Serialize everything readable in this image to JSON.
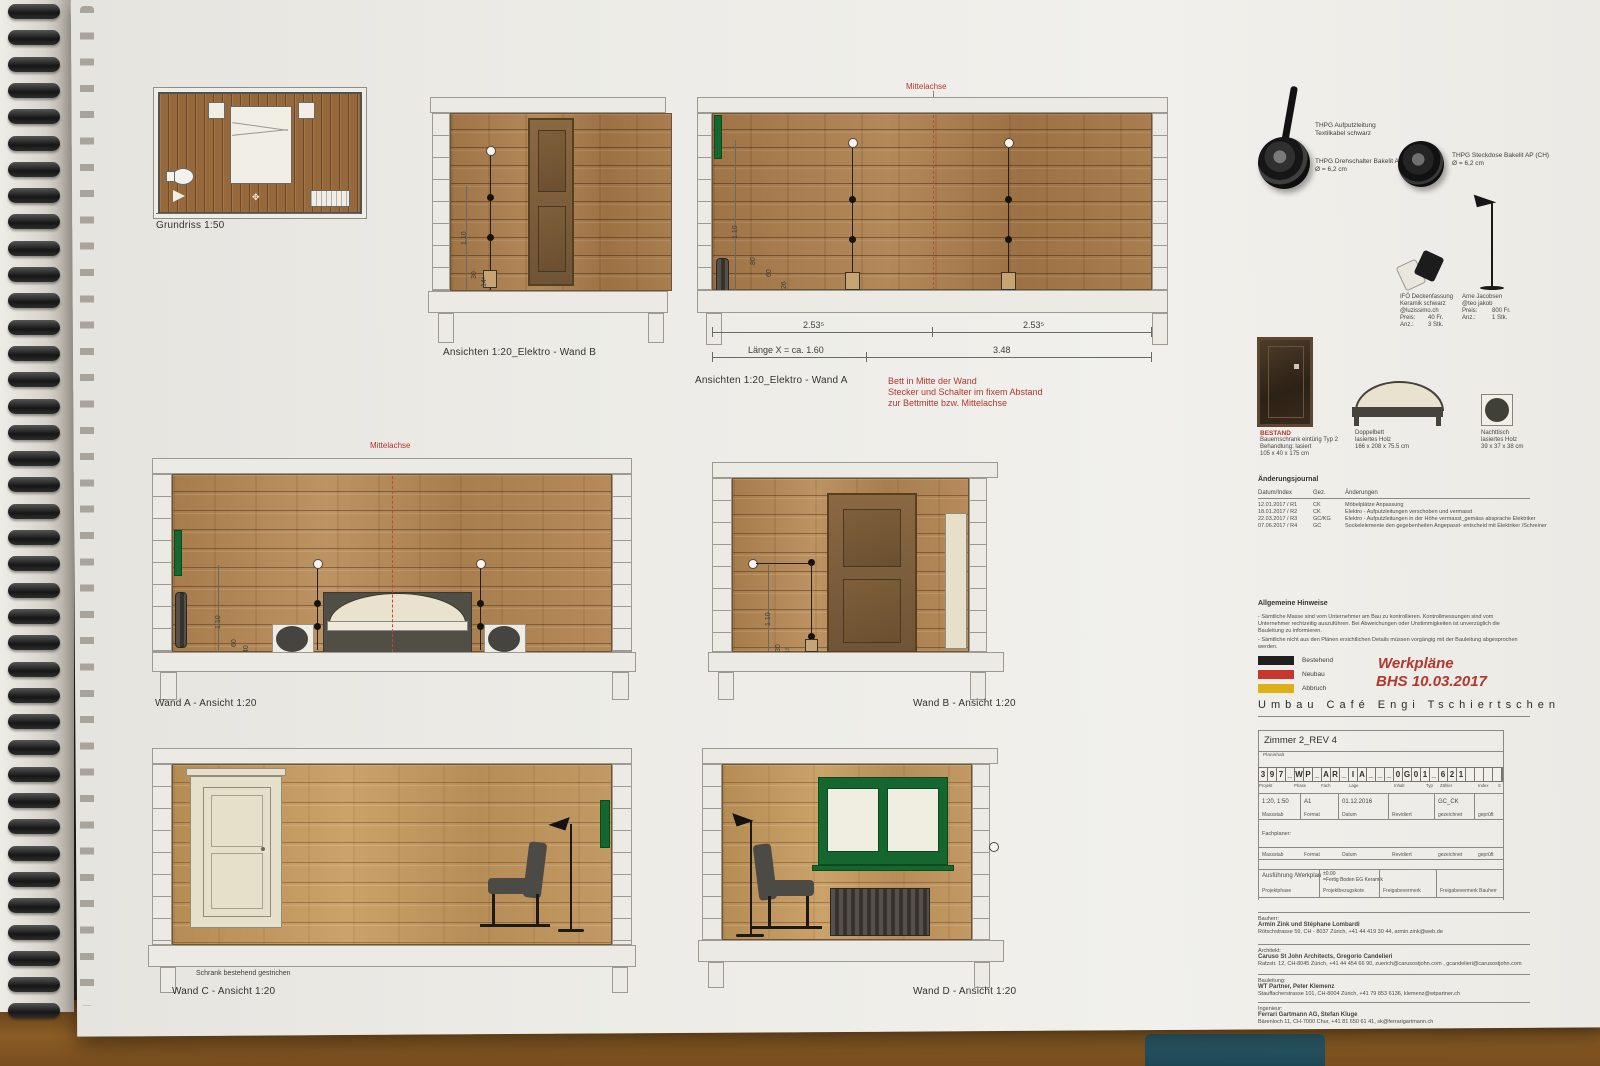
{
  "drawings": {
    "grundriss": {
      "label": "Grundriss 1:50"
    },
    "elektro_b": {
      "label": "Ansichten 1:20_Elektro - Wand B",
      "dims": {
        "h1": "1.10",
        "h2": "30",
        "h3": "14⁵"
      }
    },
    "elektro_a": {
      "label": "Ansichten 1:20_Elektro - Wand A",
      "mittelachse": "Mittelachse",
      "dims": {
        "h1": "1.10",
        "h2": "80",
        "h3": "60",
        "h4": "26",
        "w1": "2.53⁵",
        "w2": "2.53⁵",
        "x": "Länge X = ca. 1.60",
        "w3": "3.48"
      },
      "note": {
        "l1": "Bett in Mitte der Wand",
        "l2": "Stecker und Schalter im fixem Abstand",
        "l3": "zur Bettmitte bzw. Mittelachse"
      }
    },
    "wand_a": {
      "label": "Wand A - Ansicht 1:20",
      "mittelachse": "Mittelachse",
      "dims": {
        "h1": "1.10",
        "h2": "60",
        "h3": "40",
        "h4": "26"
      }
    },
    "wand_b": {
      "label": "Wand B - Ansicht 1:20",
      "dims": {
        "h1": "1.10",
        "h2": "30",
        "h3": "14⁵"
      }
    },
    "wand_c": {
      "label": "Wand C - Ansicht 1:20",
      "note": "Schrank bestehend gestrichen"
    },
    "wand_d": {
      "label": "Wand D - Ansicht 1:20"
    }
  },
  "products": {
    "leitung": {
      "l1": "THPG Aufputzleitung",
      "l2": "Textilkabel schwarz"
    },
    "schalter": {
      "l1": "THPG Drehschalter Bakelit AP",
      "l2": "Ø = 6,2 cm"
    },
    "steckdose": {
      "l1": "THPG Steckdose Bakelit AP (CH)",
      "l2": "Ø = 6,2 cm"
    },
    "deckenfassung": {
      "l1": "IFÖ Deckenfassung",
      "l2": "Keramik schwarz",
      "l3": "@luzissimo.ch",
      "preis_label": "Preis:",
      "preis": "40 Fr.",
      "anz_label": "Anz.:",
      "anz": "3 Stk."
    },
    "stehleuchte": {
      "l1": "Arne Jacobsen",
      "l2": "@teo jakob",
      "preis_label": "Preis:",
      "preis": "800 Fr.",
      "anz_label": "Anz.:",
      "anz": "1 Stk."
    },
    "bestand": {
      "tag": "BESTAND",
      "l1": "Bauernschrank eintürig Typ 2",
      "l2": "Behandlung: lasiert",
      "l3": "105 x 40 x 175 cm"
    },
    "doppelbett": {
      "l1": "Doppelbett",
      "l2": "lasiertes Holz",
      "l3": "166 x 208 x 75.5 cm"
    },
    "nachttisch": {
      "l1": "Nachttisch",
      "l2": "lasiertes Holz",
      "l3": "39 x 37 x 38 cm"
    }
  },
  "journal": {
    "title": "Änderungsjournal",
    "cols": [
      "Datum/Index",
      "Gez.",
      "Änderungen"
    ],
    "rows": [
      [
        "12.01.2017 / R1",
        "CK",
        "Möbelplätze Anpassung"
      ],
      [
        "18.01.2017 / R2",
        "CK",
        "Elektro - Aufputzleitungen verschoben und vermasst"
      ],
      [
        "22.03.2017 / R3",
        "GC/KG",
        "Elektro - Aufputzleitungen in der Höhe vermasst_gemäss absprache Elektriker"
      ],
      [
        "07.06.2017 / R4",
        "GC",
        "Sockelelemente den gegebenheiten Angepasst- entscheid mit Elektriker /Schreiner"
      ]
    ]
  },
  "hinweise": {
    "title": "Allgemeine Hinweise",
    "p1": "- Sämtliche Masse sind vom Unternehmer am Bau zu kontrollieren. Kontrollmessungen sind vom Unternehmer rechtzeitig auszuführen. Bei Abweichungen oder Unstimmigkeiten ist unverzüglich die Bauleitung zu informieren.",
    "p2": "- Sämtliche nicht aus den Plänen ersichtlichen Details müssen vorgängig mit der Bauleitung abgesprochen werden."
  },
  "legend": {
    "items": [
      {
        "label": "Bestehend",
        "color": "#1f1f1f"
      },
      {
        "label": "Neubau",
        "color": "#c8372d"
      },
      {
        "label": "Abbruch",
        "color": "#ddb116"
      }
    ]
  },
  "stamp": {
    "line1": "Werkpläne",
    "line2": "BHS 10.03.2017",
    "color": "#b2372c"
  },
  "project_title": "Umbau Café Engi Tschiertschen",
  "titleblock": {
    "plan_title": "Zimmer 2_REV 4",
    "plan_title_label": "Planinhalt",
    "plan_number": "397_WP_AR_IA___0G01_621",
    "number_labels": [
      "Projekt",
      "Phase",
      "Fach",
      "Lage",
      "Inhalt",
      "Typ",
      "Zähler",
      "Index",
      "S"
    ],
    "row1": {
      "massstab": "1:20, 1:50",
      "format": "A1",
      "datum": "01.12.2016",
      "revidiert": "",
      "gezeichnet": "GC_CK",
      "geprueft": ""
    },
    "row_labels": [
      "Massstab",
      "Format",
      "Datum",
      "Revidiert",
      "gezeichnet",
      "geprüft"
    ],
    "fachplaner_label": "Fachplaner:",
    "row3": {
      "projektphase": "Ausführung /Werkplan",
      "kote1": "±0.00",
      "kote2": "=Fertig Boden EG Keramik"
    },
    "row3_labels": [
      "Projektphase",
      "Projektbezugskote",
      "Freigabevermerk",
      "Freigabevermerk Bauherr"
    ]
  },
  "contacts": [
    {
      "role": "Bauherr:",
      "name": "Armin Zink und Stéphane Lombardi",
      "address": "Rötschstrasse 59, CH - 8037 Zürich, +41 44 419 30 44, armin.zink@web.de"
    },
    {
      "role": "Architekt:",
      "name": "Caruso St John Architects, Gregorio Candelieri",
      "address": "Rafzstr. 12, CH-8045 Zürich, +41 44 454 66 90, zuerich@carusostjohn.com , gcandelieri@carusostjohn.com"
    },
    {
      "role": "Bauleitung:",
      "name": "WT Partner, Peter Klemenz",
      "address": "Stauffacherstrasse 101, CH-8004 Zürich, +41 79 853 6136, klemenz@wtpartner.ch"
    },
    {
      "role": "Ingenieur:",
      "name": "Ferrari Gartmann AG, Stefan Kluge",
      "address": "Bärenloch 11, CH-7000 Chur, +41 81 650 61 41, sk@ferrarigartmann.ch"
    }
  ]
}
